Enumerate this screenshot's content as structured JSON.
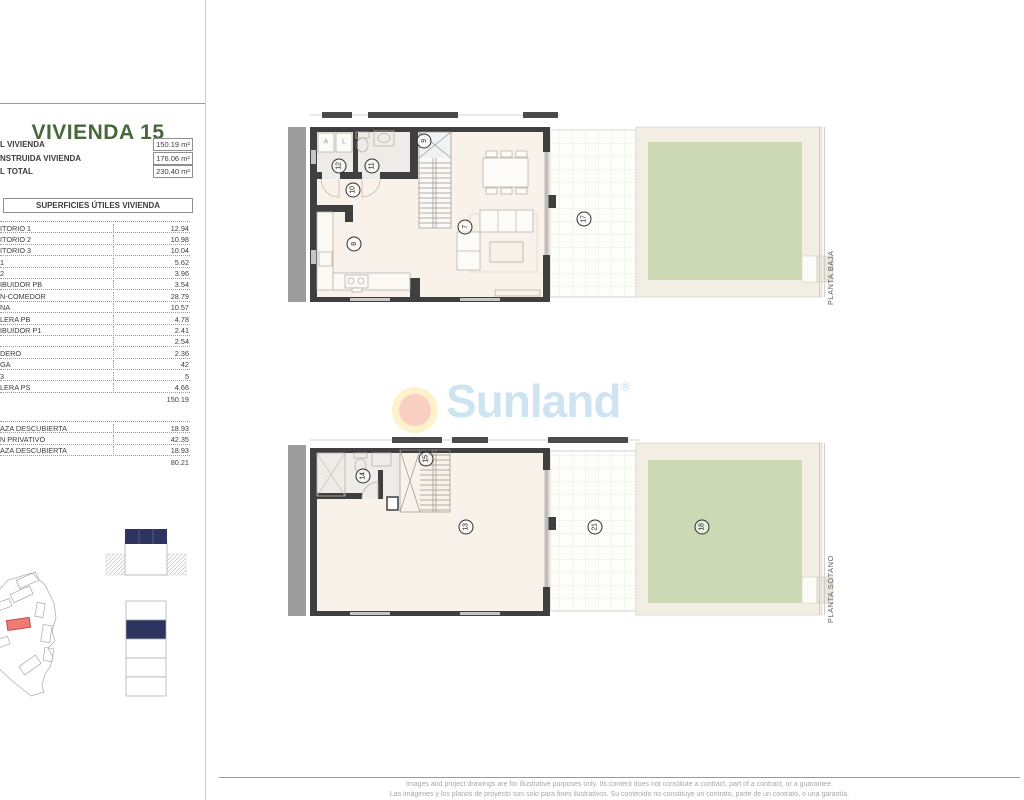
{
  "panel": {
    "title": "VIVIENDA 15",
    "summary": [
      {
        "label": "L VIVIENDA",
        "value": "150.19 m²"
      },
      {
        "label": "NSTRUIDA VIVIENDA",
        "value": "176.06 m²"
      },
      {
        "label": "L TOTAL",
        "value": "230.40 m²"
      }
    ],
    "areas_header": "SUPERFICIES ÚTILES VIVIENDA",
    "table1": {
      "rows": [
        [
          "ITORIO 1",
          "12.94"
        ],
        [
          "ITORIO 2",
          "10.98"
        ],
        [
          "ITORIO 3",
          "10.04"
        ],
        [
          "1",
          "5.62"
        ],
        [
          "2",
          "3.96"
        ],
        [
          "IBUIDOR PB",
          "3.54"
        ],
        [
          "N-COMEDOR",
          "28.79"
        ],
        [
          "NA",
          "10.57"
        ],
        [
          "LERA PB",
          "4.78"
        ],
        [
          "IBUIDOR P1",
          "2.41"
        ],
        [
          "",
          "2.54"
        ],
        [
          "DERO",
          "2.36"
        ],
        [
          "GA",
          "42"
        ],
        [
          "3",
          "5"
        ],
        [
          "LERA PS",
          "4.66"
        ]
      ],
      "total": "150.19"
    },
    "table2": {
      "rows": [
        [
          "AZA DESCUBIERTA",
          "18.93"
        ],
        [
          "N PRIVATIVO",
          "42.35"
        ],
        [
          "AZA DESCUBIERTA",
          "18.93"
        ]
      ],
      "total": "80.21"
    }
  },
  "plans": {
    "baja": {
      "label": "PLANTA BAJA",
      "markers": [
        {
          "n": "12",
          "x": 339,
          "y": 166
        },
        {
          "n": "11",
          "x": 372,
          "y": 166
        },
        {
          "n": "10",
          "x": 353,
          "y": 190
        },
        {
          "n": "9",
          "x": 424,
          "y": 141
        },
        {
          "n": "8",
          "x": 354,
          "y": 244
        },
        {
          "n": "7",
          "x": 465,
          "y": 227
        },
        {
          "n": "17",
          "x": 584,
          "y": 219
        }
      ],
      "letters": [
        {
          "t": "A",
          "x": 326,
          "y": 142
        },
        {
          "t": "L",
          "x": 344,
          "y": 142
        }
      ]
    },
    "sotano": {
      "label": "PLANTA SÓTANO",
      "markers": [
        {
          "n": "14",
          "x": 363,
          "y": 476
        },
        {
          "n": "15",
          "x": 426,
          "y": 459
        },
        {
          "n": "13",
          "x": 466,
          "y": 527
        },
        {
          "n": "21",
          "x": 595,
          "y": 527
        },
        {
          "n": "18",
          "x": 702,
          "y": 527
        }
      ]
    }
  },
  "watermark": {
    "text": "Sunland",
    "reg": "®"
  },
  "footer": {
    "line1": "Images and project drawings are for illustrative purposes only. Its content does not constitute a contract, part of a contract, or a guarantee.",
    "line2": "Las imágenes y los planos de proyecto son solo para fines ilustrativos. Su contenido no constituye un contrato, parte de un contrato, o una garantía."
  },
  "colors": {
    "title_green": "#46683c",
    "navy": "#2d3460",
    "highlight_red": "#ee7b74",
    "garden_green": "#cdd9b4",
    "floor_cream": "#f9f2ea",
    "wall_dark": "#3f3f3f",
    "watermark_blue": "#cfe4f1",
    "sun_yellow": "#fdf2cb",
    "sun_inner": "#f8cfc0"
  }
}
